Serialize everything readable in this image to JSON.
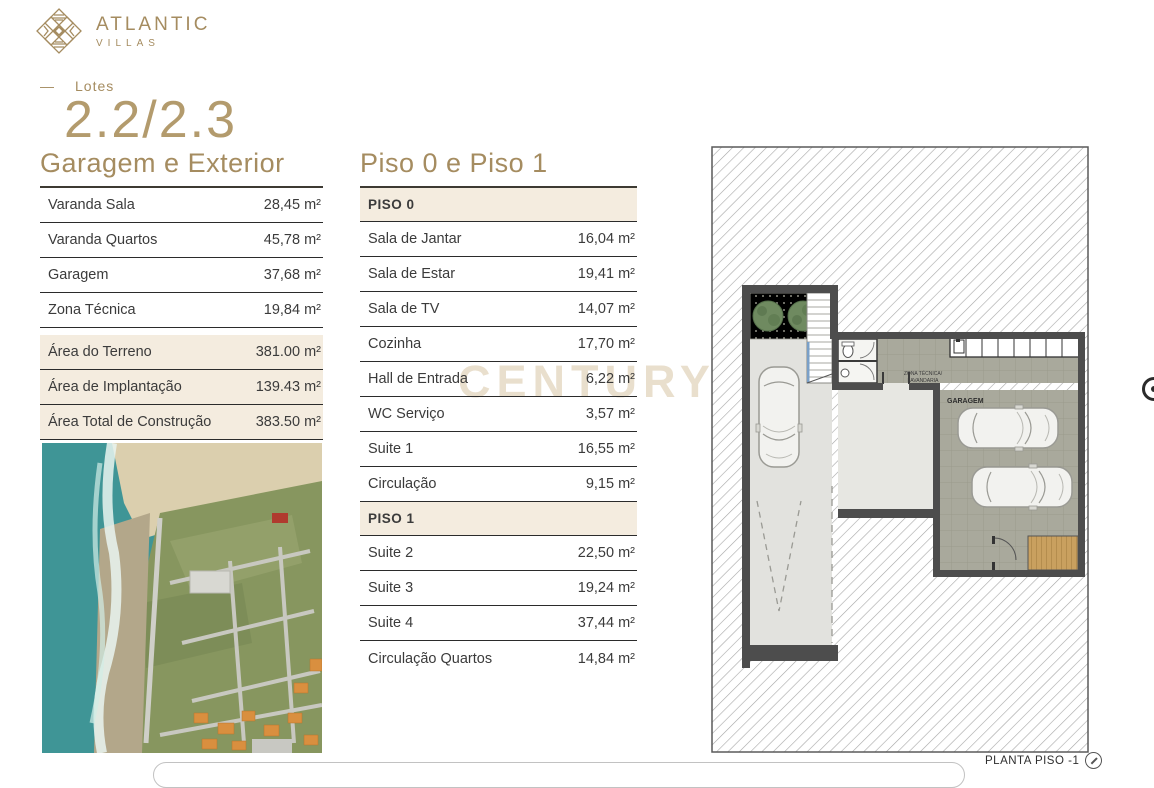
{
  "brand": {
    "name": "ATLANTIC",
    "sub": "VILLAS"
  },
  "lot": {
    "dash": "—",
    "label": "Lotes",
    "number": "2.2/2.3"
  },
  "left_table": {
    "title": "Garagem e Exterior",
    "rows": [
      {
        "label": "Varanda Sala",
        "value": "28,45 m²"
      },
      {
        "label": "Varanda Quartos",
        "value": "45,78 m²"
      },
      {
        "label": "Garagem",
        "value": "37,68 m²"
      },
      {
        "label": "Zona Técnica",
        "value": "19,84 m²"
      }
    ],
    "highlight_rows": [
      {
        "label": "Área do Terreno",
        "value": "381.00 m²"
      },
      {
        "label": "Área de Implantação",
        "value": "139.43 m²"
      },
      {
        "label": "Área Total de Construção",
        "value": "383.50 m²"
      }
    ]
  },
  "middle_table": {
    "title": "Piso 0 e Piso 1",
    "piso0_header": "PISO 0",
    "piso0_rows": [
      {
        "label": "Sala de Jantar",
        "value": "16,04 m²"
      },
      {
        "label": "Sala de Estar",
        "value": "19,41 m²"
      },
      {
        "label": "Sala de TV",
        "value": "14,07 m²"
      },
      {
        "label": "Cozinha",
        "value": "17,70 m²"
      },
      {
        "label": "Hall de Entrada",
        "value": "6,22 m²"
      },
      {
        "label": "WC Serviço",
        "value": "3,57 m²"
      },
      {
        "label": "Suite 1",
        "value": "16,55 m²"
      },
      {
        "label": "Circulação",
        "value": "9,15 m²"
      }
    ],
    "piso1_header": "PISO 1",
    "piso1_rows": [
      {
        "label": "Suite 2",
        "value": "22,50 m²"
      },
      {
        "label": "Suite 3",
        "value": "19,24 m²"
      },
      {
        "label": "Suite 4",
        "value": "37,44 m²"
      },
      {
        "label": "Circulação Quartos",
        "value": "14,84 m²"
      }
    ]
  },
  "floor_plan": {
    "label_zona_line1": "ZONA TÉCNICA/",
    "label_zona_line2": "LAVANDARIA",
    "label_garagem": "GARAGEM",
    "caption": "PLANTA PISO -1"
  },
  "watermark": "CENTURY 21",
  "colors": {
    "gold": "#a58c60",
    "gold_light": "#b39b6d",
    "beige_highlight": "#f4ecdf",
    "watermark": "#e9dfcd",
    "text": "#3b3b3b",
    "row_border": "#2b2b2b",
    "wall": "#4d4d4d",
    "garage_floor": "#a9a99c"
  }
}
